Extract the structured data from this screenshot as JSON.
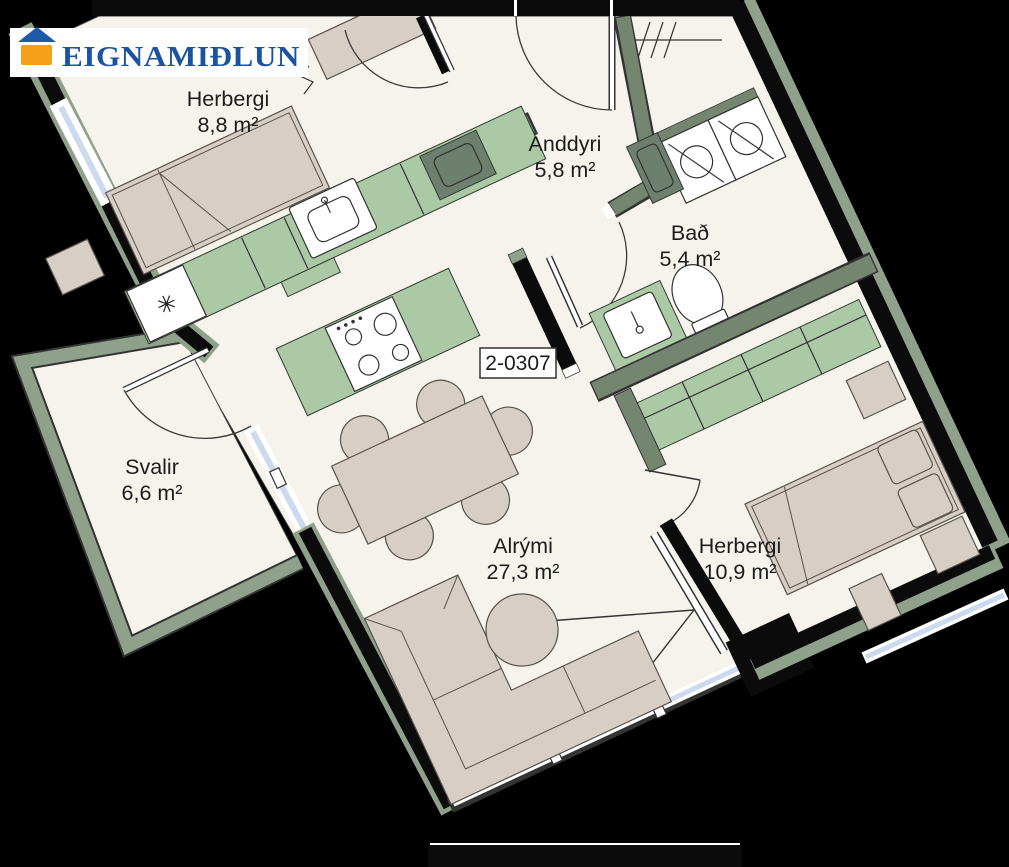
{
  "logo": {
    "brand": "EIGNAMIÐLUN"
  },
  "unit": {
    "label": "2-0307"
  },
  "rooms": [
    {
      "id": "herbergi-1",
      "name": "Herbergi",
      "area": "8,8 m²"
    },
    {
      "id": "anddyri",
      "name": "Anddyri",
      "area": "5,8 m²"
    },
    {
      "id": "bad",
      "name": "Bað",
      "area": "5,4 m²"
    },
    {
      "id": "svalir",
      "name": "Svalir",
      "area": "6,6 m²"
    },
    {
      "id": "alrymi",
      "name": "Alrými",
      "area": "27,3 m²"
    },
    {
      "id": "herbergi-2",
      "name": "Herbergi",
      "area": "10,9 m²"
    }
  ],
  "symbols": {
    "freezer": "✳"
  },
  "colors": {
    "background": "#000000",
    "floor": "#f6f3ed",
    "exterior_trim": "#8fa08b",
    "interior_wall": "#748670",
    "counter_green": "#abc9a5",
    "cabinet_dark": "#6d7f6e",
    "furniture_beige": "#d7cfc6",
    "glazing_blue": "#cbdaec",
    "logo_blue": "#1b53a0",
    "logo_orange": "#f5a018"
  }
}
